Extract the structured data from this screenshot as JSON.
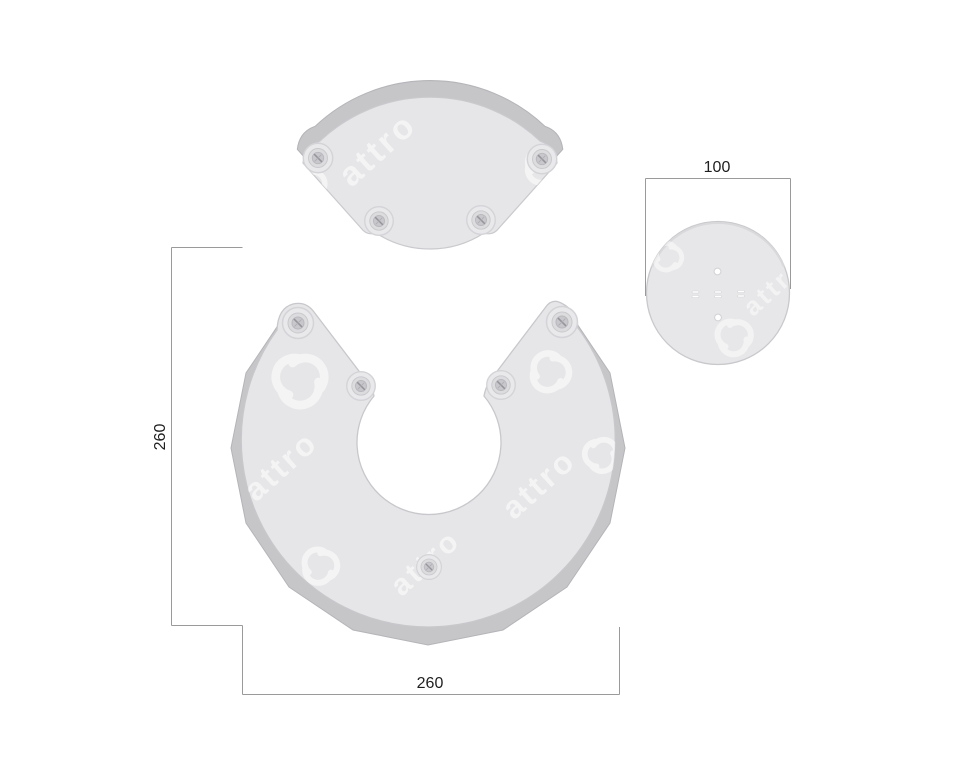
{
  "drawing": {
    "type": "technical-part-drawing",
    "parts": [
      {
        "id": "fan-plate",
        "description": "fan shaped plate, 4 screws"
      },
      {
        "id": "ring-plate",
        "description": "open C ring plate, 5 screws"
      },
      {
        "id": "round-plate",
        "description": "round plate with small holes"
      }
    ],
    "dimensions": {
      "round_plate_width": "100",
      "ring_plate_height": "260",
      "ring_plate_width": "260"
    },
    "watermark": {
      "text": "attro",
      "logo": "triple-swirl-logo"
    },
    "colors": {
      "background": "#ffffff",
      "face_gray": "#e6e6e8",
      "back_plate_gray": "#c6c6c9",
      "edge_gray": "#c8c8cc",
      "dim_line": "#9a9a9a",
      "dim_text": "#1f1f1f",
      "watermark": "#ffffff"
    }
  }
}
